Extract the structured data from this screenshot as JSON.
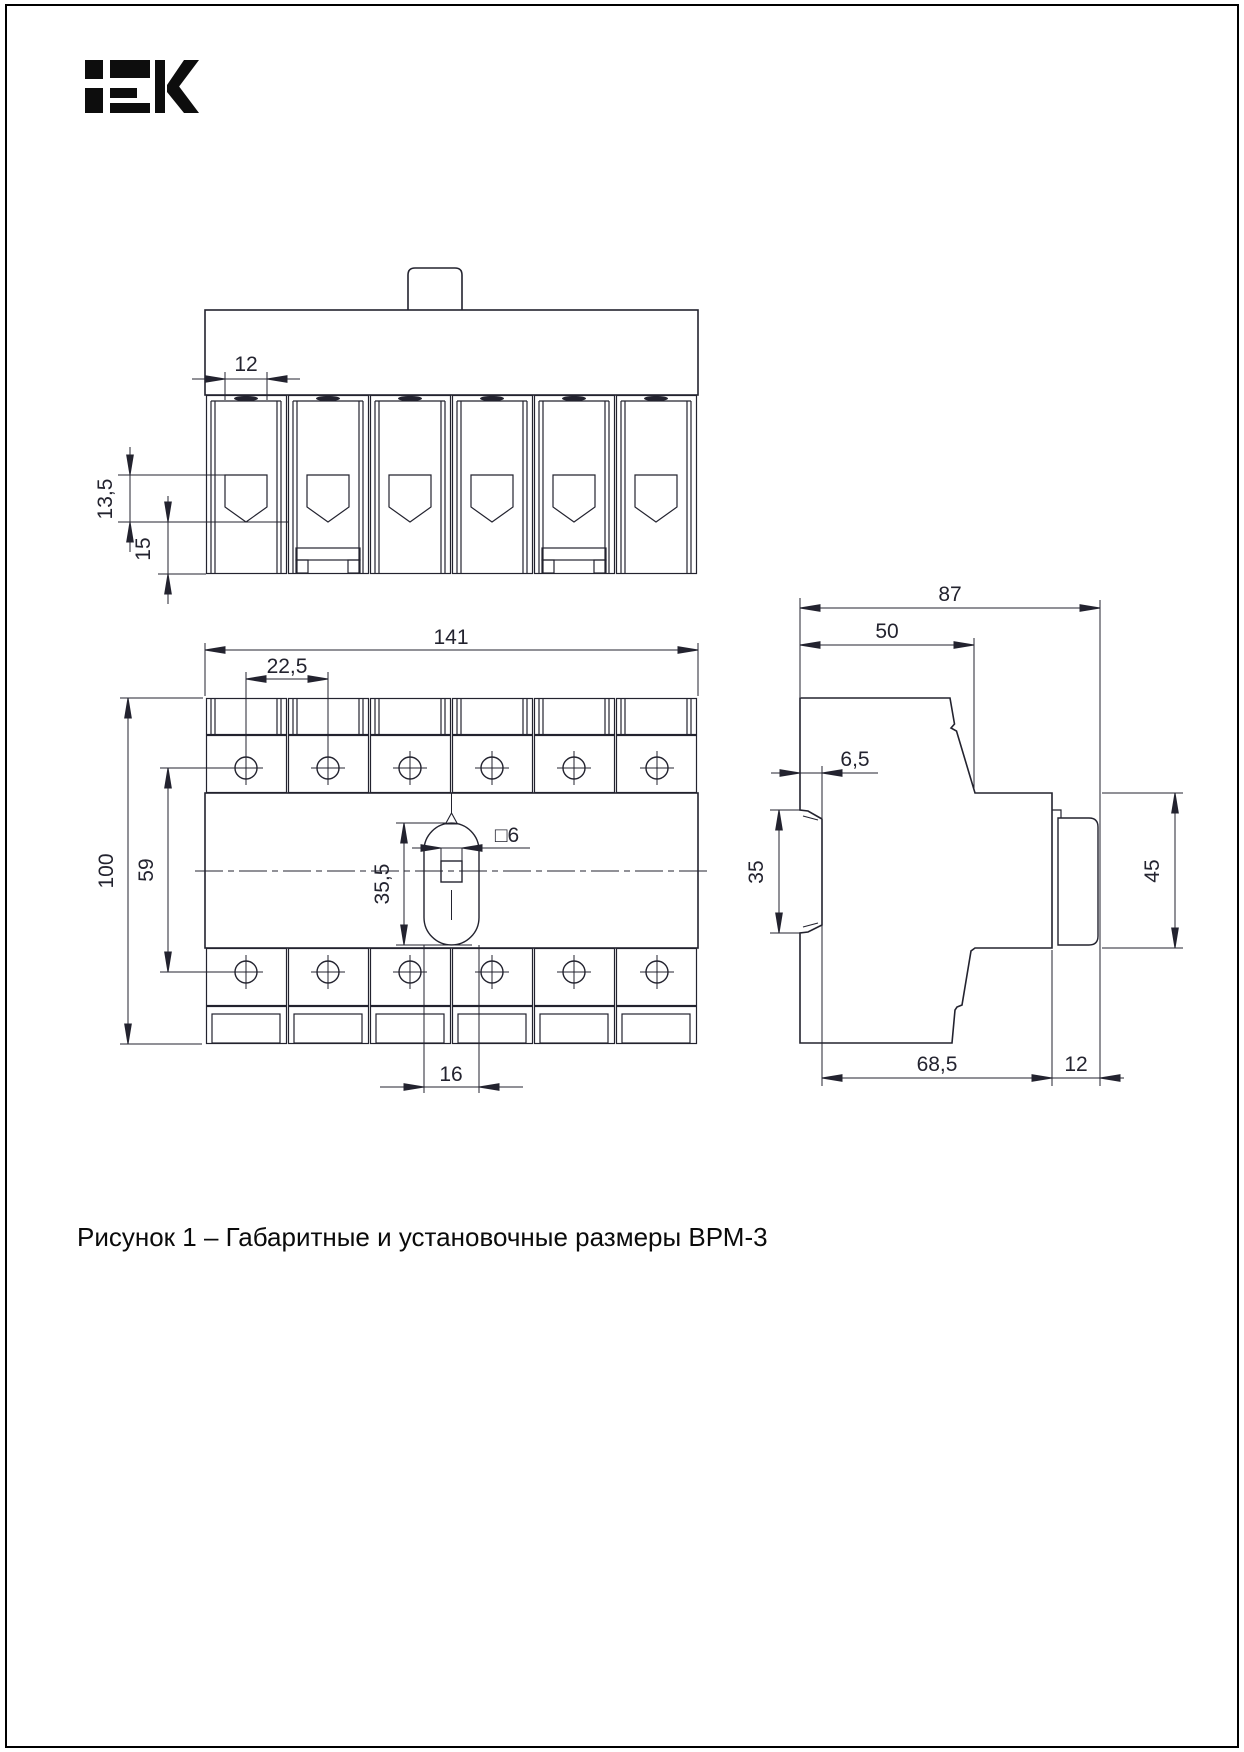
{
  "page": {
    "background": "#ffffff",
    "border_color": "#000000",
    "line_color": "#23232f",
    "logo_color": "#0d0d0d",
    "caption": "Рисунок 1 – Габаритные и установочные размеры ВРМ-3"
  },
  "figure": {
    "number": "Рисунок 1",
    "title": "Габаритные и установочные размеры ВРМ-3",
    "product": "ВРМ-3"
  },
  "dims": {
    "top": {
      "d12": "12",
      "d135": "13,5",
      "d15": "15"
    },
    "front": {
      "d141": "141",
      "d225": "22,5",
      "d100": "100",
      "d59": "59",
      "d355": "35,5",
      "d6": "□6",
      "d16": "16"
    },
    "side": {
      "d87": "87",
      "d50": "50",
      "d65": "6,5",
      "d35": "35",
      "d45": "45",
      "d685": "68,5",
      "d12": "12"
    }
  }
}
